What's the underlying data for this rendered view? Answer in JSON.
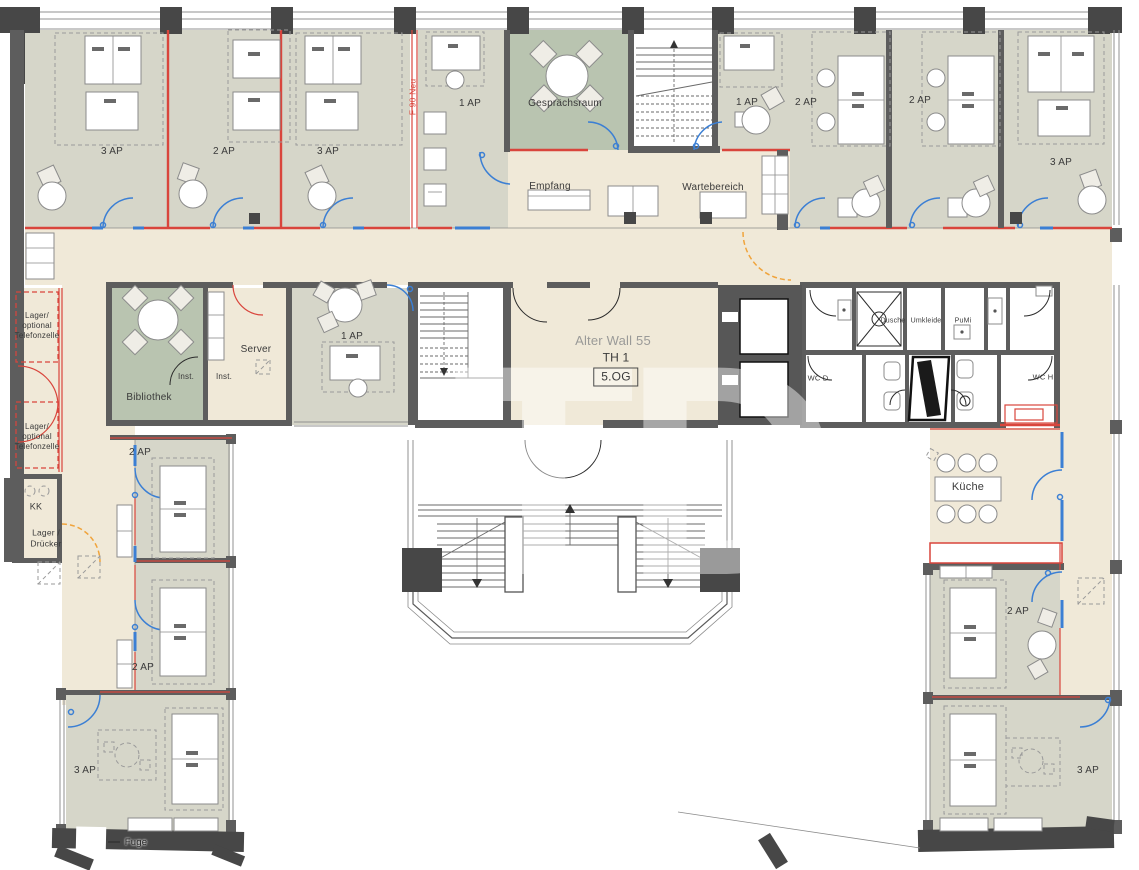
{
  "colors": {
    "corridor_fill": "#f0e9d8",
    "office_fill": "#d6d6c9",
    "meeting_fill": "#b9c4b0",
    "wall": "#5d5d5d",
    "fire_wall_red": "#d9453c",
    "door_blue": "#3b7fd4",
    "door_orange": "#f0a43c",
    "label_text": "#3a3a3a"
  },
  "building": {
    "address_watermark": "Alter Wall 55",
    "staircase_label": "TH 1",
    "floor_label": "5.OG",
    "fire_protection_label": "F 90 Neu",
    "joint_label": "Fuge",
    "watermark": "TD"
  },
  "rooms": {
    "top_left_office_1": "3 AP",
    "top_left_office_2": "2 AP",
    "top_left_office_3": "3 AP",
    "top_center_office_left": "1 AP",
    "meeting_room": "Gesprächsraum",
    "top_center_office_right": "1 AP",
    "reception": "Empfang",
    "waiting_area": "Wartebereich",
    "top_right_office_1": "2 AP",
    "top_right_office_2": "2 AP",
    "top_right_office_3": "3 AP",
    "storage_phonebooth_1": "Lager/\noptional\nTelefonzelle",
    "storage_phonebooth_2": "Lager/\noptional\nTelefonzelle",
    "library": "Bibliothek",
    "server_room": "Server",
    "inst_1": "Inst.",
    "inst_2": "Inst.",
    "mid_left_office": "1 AP",
    "kk": "KK",
    "storage_printer": "Lager /\nDrücker",
    "west_office_1": "2 AP",
    "west_office_2": "2 AP",
    "south_west_office": "3 AP",
    "shower": "Dusche",
    "changing_room": "Umkleide",
    "cleaning_room": "PuMi",
    "wc_women": "WC D",
    "wc_men": "WC H",
    "kitchen": "Küche",
    "east_office": "2 AP",
    "south_east_office": "3 AP"
  }
}
